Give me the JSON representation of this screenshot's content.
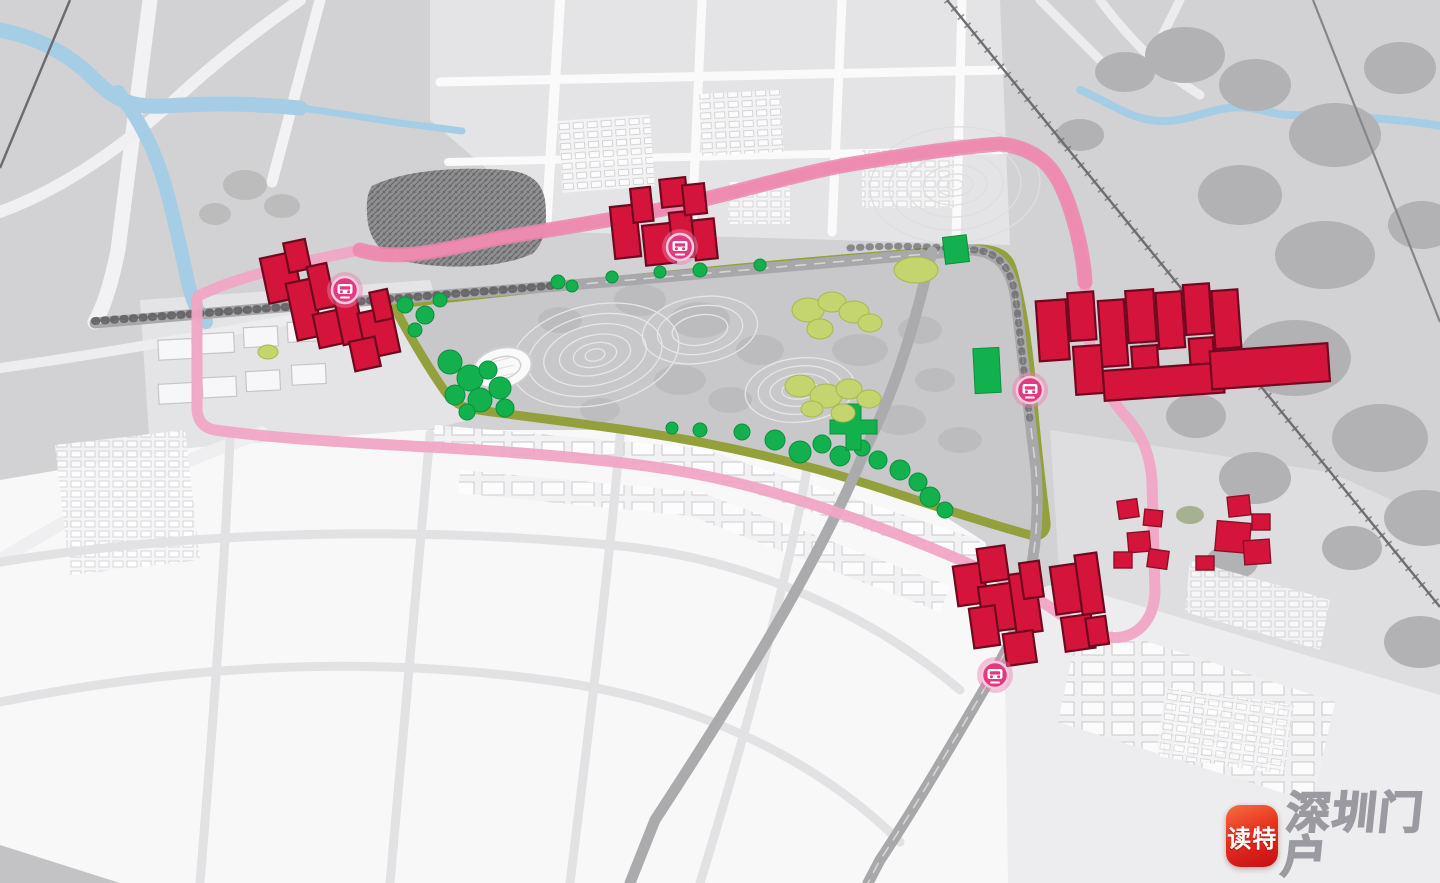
{
  "watermark": {
    "app_name": "读特",
    "site_name": "深圳门户"
  },
  "map": {
    "description_labels": {
      "metro_station_icon": "metro-station",
      "planned_buildings": "planned-building-cluster",
      "park_loop": "park-boundary-greenway",
      "metro_route": "pink-loop-route"
    },
    "stations": [
      {
        "id": "station-west",
        "x": 345,
        "y": 290
      },
      {
        "id": "station-north",
        "x": 680,
        "y": 247
      },
      {
        "id": "station-east",
        "x": 1030,
        "y": 390
      },
      {
        "id": "station-south",
        "x": 995,
        "y": 675
      }
    ],
    "building_clusters": [
      "west",
      "north",
      "east",
      "south",
      "east-village"
    ],
    "colors": {
      "background": "#d2d2d4",
      "water": "#a5cde6",
      "park_ring": "#93a03b",
      "park_fill": "#c8c8ca",
      "route_pink": "#f0a5c4",
      "route_pink_deep": "#ec86ad",
      "planned_red": "#d5143b",
      "planned_outline": "#70091f",
      "tree_green": "#12b14e",
      "tree_lime": "#c4d46e",
      "station_pink": "#e23a80",
      "road_gray": "#a8a8aa",
      "canopy_gray": "#b2b2b4"
    }
  }
}
